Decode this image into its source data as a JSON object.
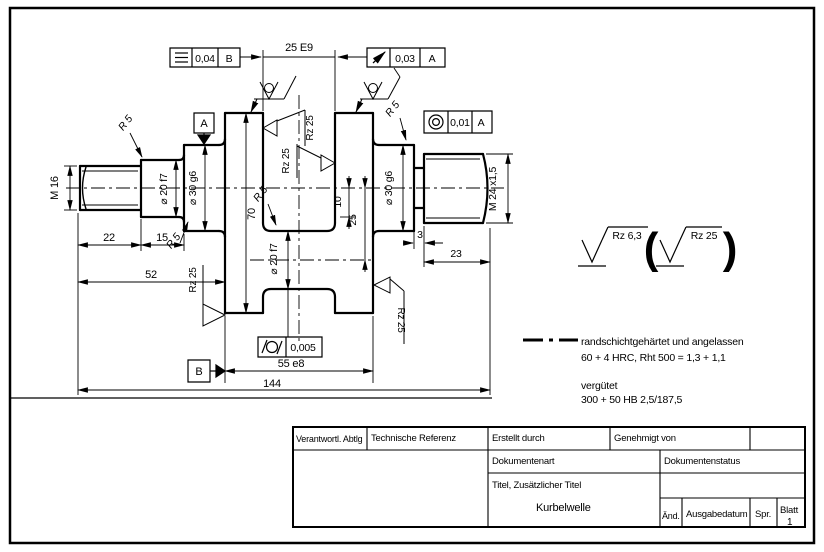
{
  "drawing": {
    "frames": {
      "symmetry": {
        "value": "0,04",
        "datum": "B"
      },
      "runout": {
        "value": "0,03",
        "datum": "A"
      },
      "circularity": {
        "value": "0,01",
        "datum": "A"
      },
      "cylindricity": {
        "value": "0,005"
      }
    },
    "datum_a": "A",
    "datum_b": "B",
    "dims": {
      "pin_width": "25 E9",
      "thread_left": "M 16",
      "dia20_left": "⌀ 20 f7",
      "dia30_left": "⌀ 30 g6",
      "web_height": "70",
      "len_22": "22",
      "len_15": "15",
      "len_52": "52",
      "len_3": "3",
      "len_23": "23",
      "len_55": "55 e8",
      "len_144": "144",
      "pin_dia": "⌀ 20 f7",
      "offset_10": "10",
      "crank_radius_25": "25",
      "dia30_right": "⌀ 30 g6",
      "thread_right": "M 24 x1,5",
      "radius": "R 5"
    },
    "roughness": {
      "rz25": "Rz 25",
      "rz63": "Rz 6,3",
      "paren_open": "(",
      "paren_close": ")"
    },
    "notes": {
      "hardening_1": "randschichtgehärtet und angelassen",
      "hardening_2": "60 + 4 HRC, Rht 500 = 1,3 + 1,1",
      "tempering_1": "vergütet",
      "tempering_2": "300 + 50 HB 2,5/187,5"
    }
  },
  "title_block": {
    "responsible_dept": "Verantwortl. Abtlg",
    "technical_reference": "Technische Referenz",
    "created_by": "Erstellt durch",
    "approved_by": "Genehmigt von",
    "document_type": "Dokumentenart",
    "document_status": "Dokumentenstatus",
    "title_label": "Titel, Zusätzlicher Titel",
    "title": "Kurbelwelle",
    "rev": "Änd.",
    "issue_date": "Ausgabedatum",
    "lang": "Spr.",
    "sheet": "Blatt",
    "sheet_no": "1"
  }
}
